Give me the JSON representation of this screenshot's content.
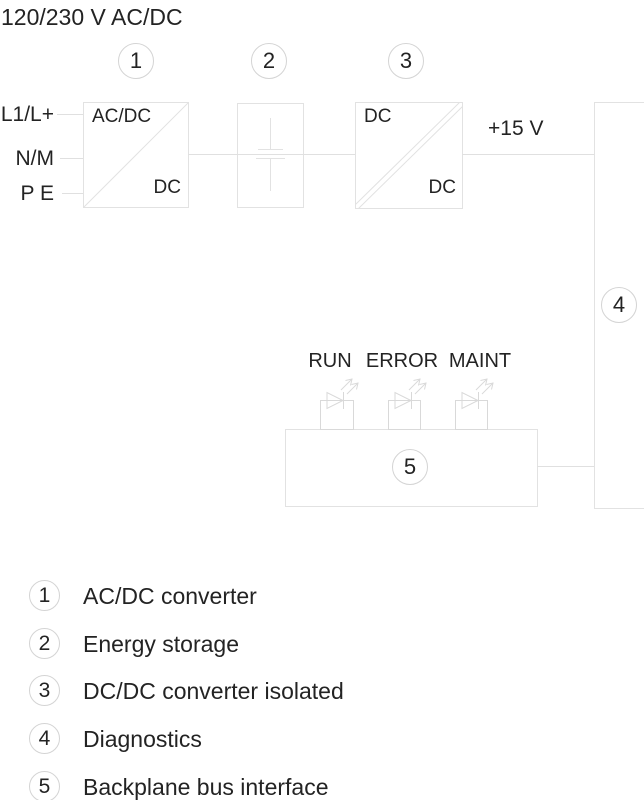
{
  "title": "120/230 V AC/DC",
  "inputs": {
    "l1": "L1/L+",
    "n": "N/M",
    "pe": "P E"
  },
  "output": {
    "label": "+15 V"
  },
  "blocks": {
    "b1": {
      "num": "1",
      "tl": "AC/DC",
      "br": "DC"
    },
    "b2": {
      "num": "2"
    },
    "b3": {
      "num": "3",
      "tl": "DC",
      "br": "DC"
    },
    "b4": {
      "num": "4"
    },
    "b5": {
      "num": "5"
    }
  },
  "leds": [
    {
      "label": "RUN"
    },
    {
      "label": "ERROR"
    },
    {
      "label": "MAINT"
    }
  ],
  "legend": [
    {
      "num": "1",
      "label": "AC/DC converter"
    },
    {
      "num": "2",
      "label": "Energy storage"
    },
    {
      "num": "3",
      "label": "DC/DC converter isolated"
    },
    {
      "num": "4",
      "label": "Diagnostics"
    },
    {
      "num": "5",
      "label": "Backplane bus interface"
    }
  ],
  "colors": {
    "line": "#e0e0e0",
    "circle_border": "#d4d4d4",
    "led_symbol": "#d9d9d9",
    "text": "#232323"
  }
}
